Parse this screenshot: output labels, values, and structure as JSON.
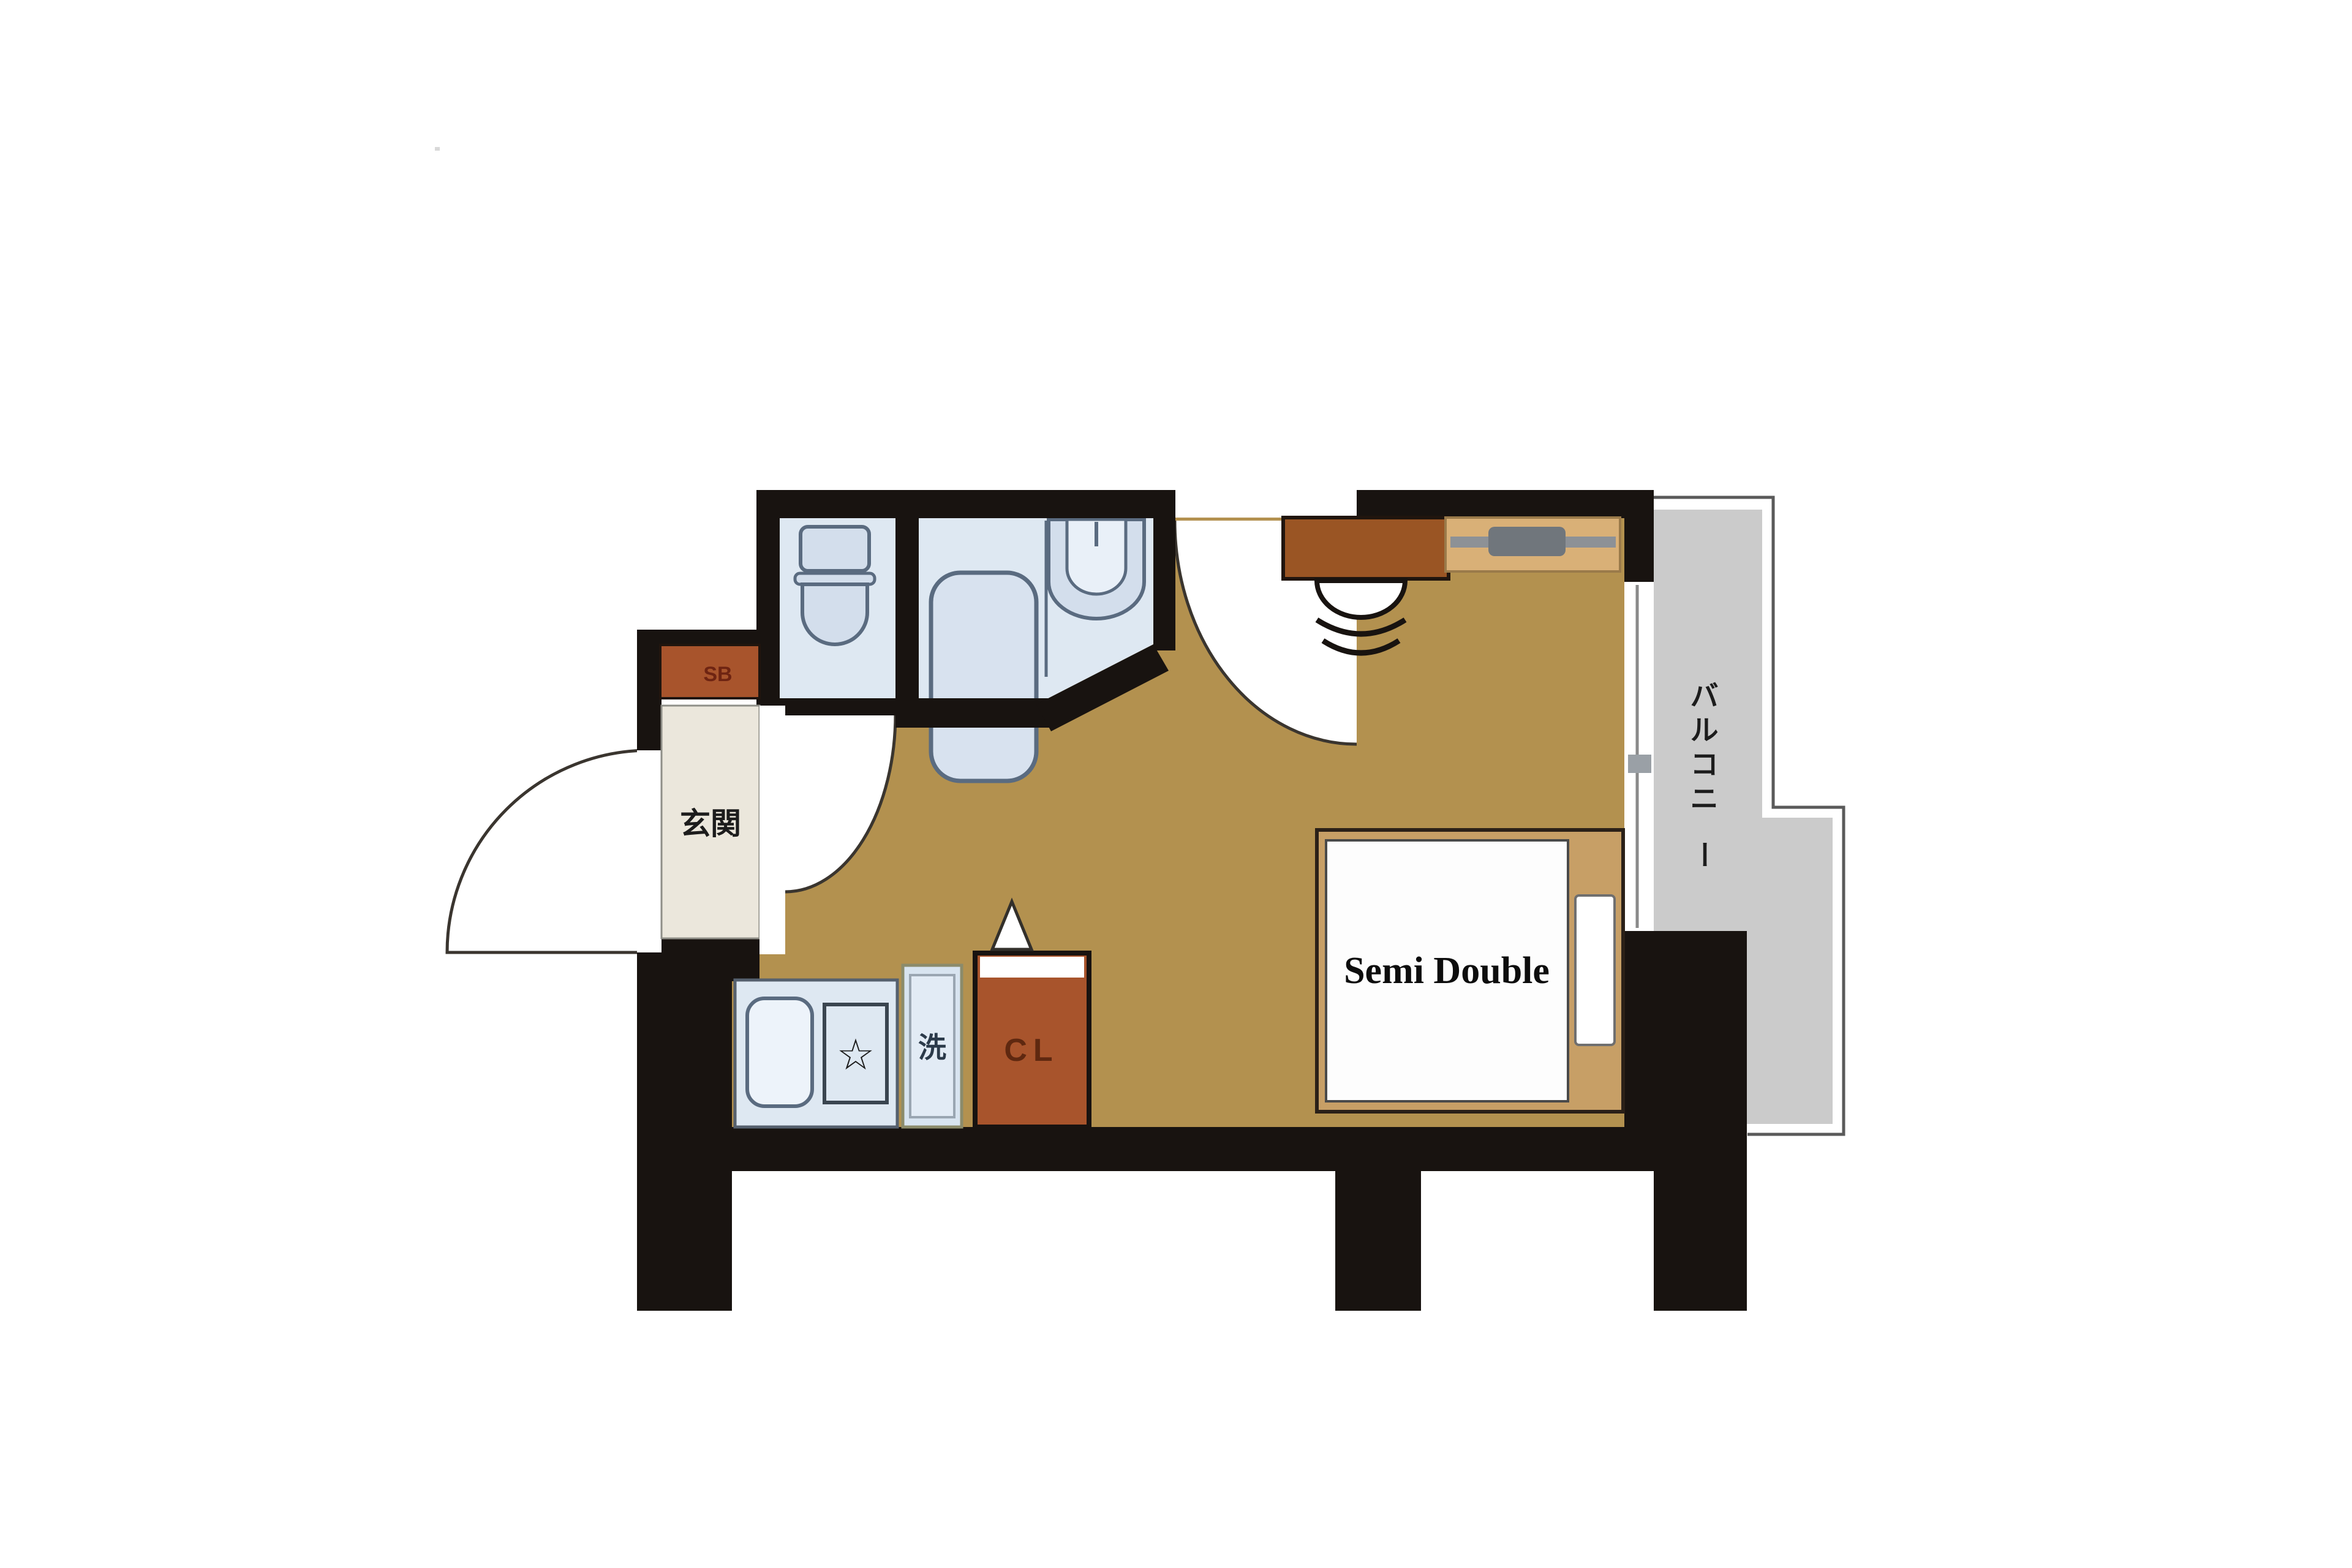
{
  "plan": {
    "type": "apartment-floor-plan",
    "labels": {
      "entrance": "玄関",
      "shoe_box": "SB",
      "closet": "CL",
      "washing_machine": "洗",
      "bed": "Semi Double",
      "balcony": "バルコニー",
      "balcony_chars": [
        "バ",
        "ル",
        "コ",
        "ニ",
        "ー"
      ],
      "stove_symbol": "☆"
    },
    "rooms": [
      {
        "name": "entrance",
        "label": "玄関"
      },
      {
        "name": "toilet",
        "label": ""
      },
      {
        "name": "bathroom",
        "label": ""
      },
      {
        "name": "kitchen",
        "label": ""
      },
      {
        "name": "main-room",
        "label": ""
      },
      {
        "name": "balcony",
        "label": "バルコニー"
      }
    ],
    "furniture": [
      {
        "name": "shoe-box",
        "label": "SB"
      },
      {
        "name": "toilet-fixture",
        "label": ""
      },
      {
        "name": "bathtub",
        "label": ""
      },
      {
        "name": "bathroom-sink",
        "label": ""
      },
      {
        "name": "kitchen-sink",
        "label": ""
      },
      {
        "name": "gas-stove",
        "label": "☆"
      },
      {
        "name": "washing-machine",
        "label": "洗"
      },
      {
        "name": "closet",
        "label": "CL"
      },
      {
        "name": "desk",
        "label": ""
      },
      {
        "name": "chair",
        "label": ""
      },
      {
        "name": "tv-board",
        "label": ""
      },
      {
        "name": "bed",
        "label": "Semi Double"
      }
    ],
    "colors": {
      "wall": "#181310",
      "flooring": "#B3914F",
      "wet_room_floor": "#DEE8F2",
      "fixture_stroke": "#5A6B80",
      "rust_furniture": "#A8542C",
      "desk": "#9A5524",
      "bed_frame": "#C79F66",
      "tv_board": "#D9B077",
      "tv": "#70767C",
      "balcony": "#CBCBCB",
      "entrance_floor": "#EBE7DC",
      "background": "#FFFFFF"
    }
  }
}
